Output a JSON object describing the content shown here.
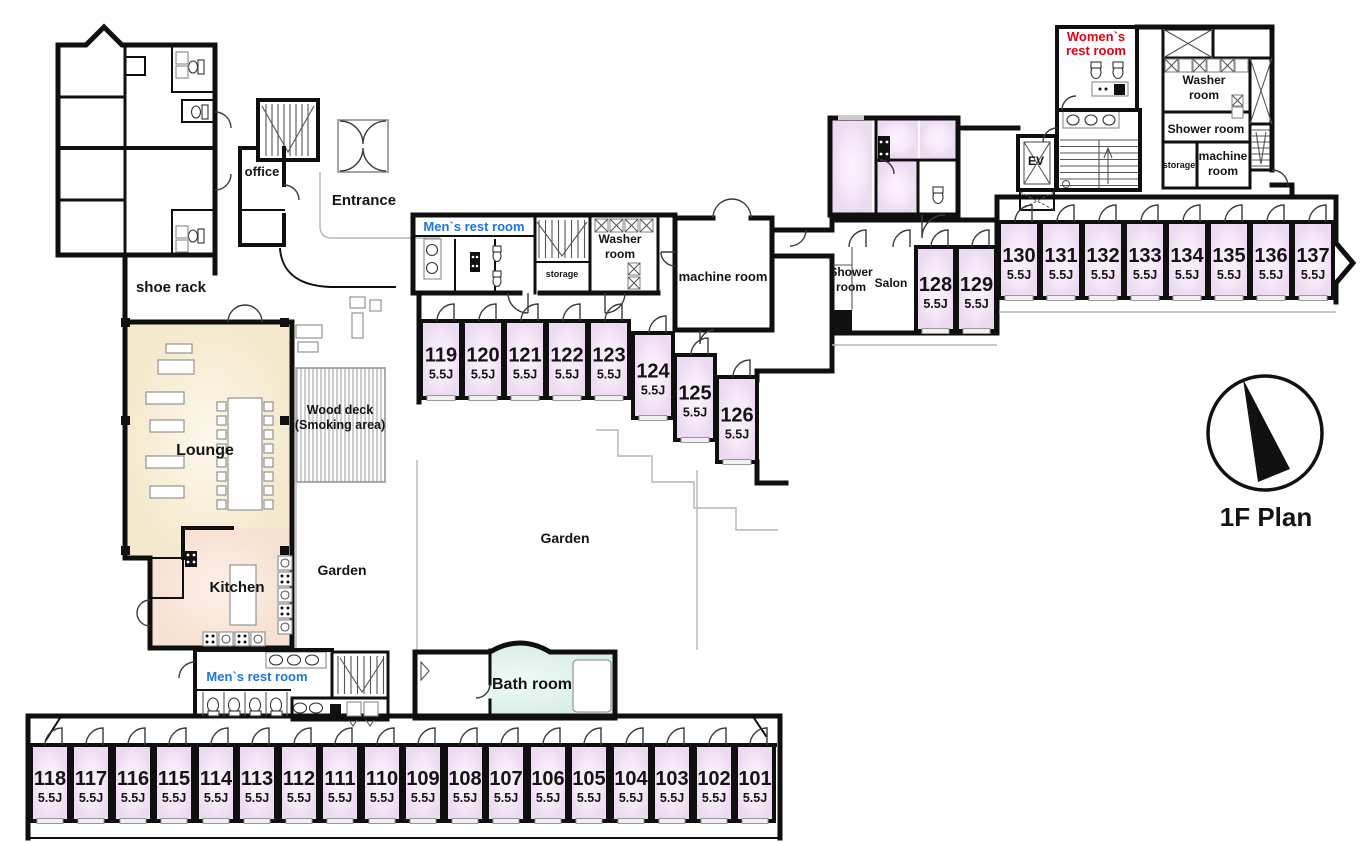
{
  "plan": {
    "floor_label": "1F Plan",
    "size_label": "5.5J"
  },
  "colors": {
    "wall": "#0f0f0f",
    "room_fill": "#f5e9f7",
    "lounge_fill": "#f9f1da",
    "kitchen_fill": "#fbe9de",
    "bath_fill": "#dff1ea",
    "accent_blue": "#1b74e8",
    "accent_red": "#e60012"
  },
  "labels": {
    "shoe_rack": "shoe rack",
    "office": "office",
    "entrance": "Entrance",
    "mens_rest_room_upper": "Men`s rest room",
    "mens_rest_room_lower": "Men`s rest room",
    "womens_rest_room_l1": "Women`s",
    "womens_rest_room_l2": "rest room",
    "washer_room_mid_l1": "Washer",
    "washer_room_mid_l2": "room",
    "washer_room_tr_l1": "Washer",
    "washer_room_tr_l2": "room",
    "shower_room_tr": "Shower room",
    "storage_mid": "storage",
    "storage_tr": "storage",
    "machine_room_mid": "machine room",
    "machine_room_tr_l1": "machine",
    "machine_room_tr_l2": "room",
    "shower_room_left_l1": "Shower",
    "shower_room_left_l2": "room",
    "salon": "Salon",
    "ev": "EV",
    "lounge": "Lounge",
    "kitchen": "Kitchen",
    "wood_deck_l1": "Wood deck",
    "wood_deck_l2": "(Smoking area)",
    "garden_left": "Garden",
    "garden_center": "Garden",
    "bath_room": "Bath room"
  },
  "room_groups": [
    {
      "name": "row-119",
      "w": 40,
      "h": 77,
      "y": 321,
      "cells": [
        {
          "n": "119",
          "x": 421
        },
        {
          "n": "120",
          "x": 463
        },
        {
          "n": "121",
          "x": 505
        },
        {
          "n": "122",
          "x": 547
        },
        {
          "n": "123",
          "x": 589
        }
      ]
    },
    {
      "name": "stepped-124",
      "w": 40,
      "h": 85,
      "cells": [
        {
          "n": "124",
          "x": 633,
          "y": 333
        },
        {
          "n": "125",
          "x": 675,
          "y": 355
        },
        {
          "n": "126",
          "x": 717,
          "y": 377
        }
      ]
    },
    {
      "name": "salon-row",
      "w": 39,
      "h": 84,
      "y": 247,
      "cells": [
        {
          "n": "128",
          "x": 916
        },
        {
          "n": "129",
          "x": 957
        }
      ]
    },
    {
      "name": "row-130",
      "w": 40,
      "h": 76,
      "y": 222,
      "cells": [
        {
          "n": "130",
          "x": 999
        },
        {
          "n": "131",
          "x": 1041
        },
        {
          "n": "132",
          "x": 1083
        },
        {
          "n": "133",
          "x": 1125
        },
        {
          "n": "134",
          "x": 1167
        },
        {
          "n": "135",
          "x": 1209
        },
        {
          "n": "136",
          "x": 1251
        },
        {
          "n": "137",
          "x": 1293
        }
      ]
    },
    {
      "name": "row-bottom",
      "w": 38,
      "h": 76,
      "y": 745,
      "cells": [
        {
          "n": "118",
          "x": 31
        },
        {
          "n": "117",
          "x": 72
        },
        {
          "n": "116",
          "x": 114
        },
        {
          "n": "115",
          "x": 155
        },
        {
          "n": "114",
          "x": 197
        },
        {
          "n": "113",
          "x": 238
        },
        {
          "n": "112",
          "x": 280
        },
        {
          "n": "111",
          "x": 321
        },
        {
          "n": "110",
          "x": 363
        },
        {
          "n": "109",
          "x": 404
        },
        {
          "n": "108",
          "x": 446
        },
        {
          "n": "107",
          "x": 487
        },
        {
          "n": "106",
          "x": 529
        },
        {
          "n": "105",
          "x": 570
        },
        {
          "n": "104",
          "x": 612
        },
        {
          "n": "103",
          "x": 653
        },
        {
          "n": "102",
          "x": 695
        },
        {
          "n": "101",
          "x": 736
        }
      ]
    }
  ]
}
